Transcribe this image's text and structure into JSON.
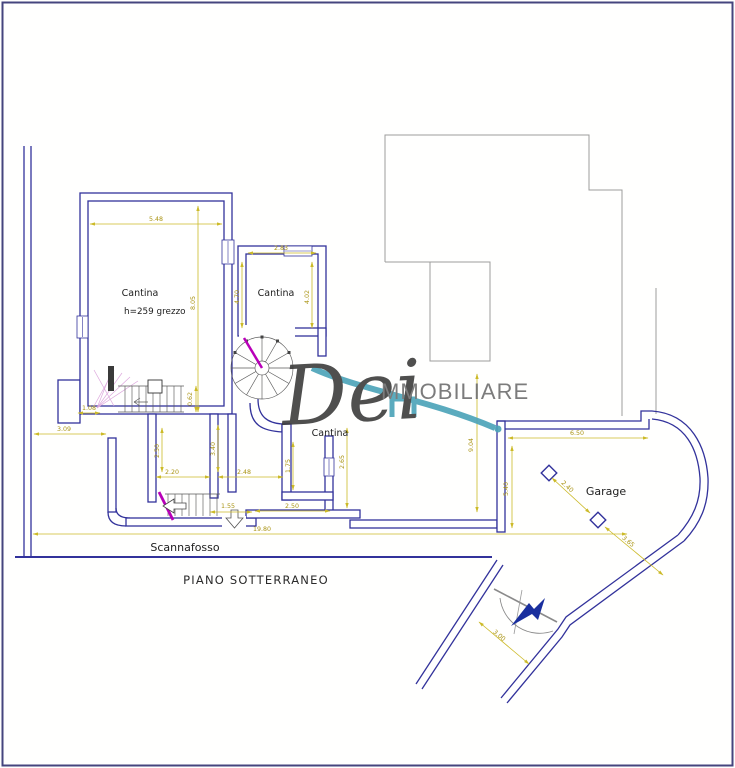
{
  "plan": {
    "title": "PIANO SOTTERRANEO",
    "rooms": {
      "cantina_nw": "Cantina",
      "cantina_nw_note": "h=259 grezzo",
      "cantina_mid": "Cantina",
      "cantina_south": "Cantina",
      "garage": "Garage",
      "scannafosso": "Scannafosso"
    },
    "dims": {
      "nw_width": "5.48",
      "nw_depth": "8.05",
      "mid_width": "2.83",
      "mid_left": "4.70",
      "mid_right": "4.02",
      "court_depth": "9.04",
      "garage_width": "6.50",
      "garage_depth": "5.40",
      "garage_diag_a": "2.40",
      "garage_diag_b": "3.65",
      "ramp_width": "3.00",
      "overall_width": "19.80",
      "west_gap": "3.09",
      "room_a_width": "2.20",
      "room_b_width": "2.48",
      "room_c_width": "2.50",
      "room_b_depth": "1.75",
      "room_c_depth": "2.65",
      "stair_room_depth": "2.50",
      "hall_depth": "3.40",
      "stair_width": "1.55",
      "stair_a": "1.08",
      "stair_b": "0.62"
    }
  },
  "watermark": {
    "script": "Dei",
    "caps": "MMOBILIARE"
  },
  "colors": {
    "wall": "#32329b",
    "dimension": "#b7a315",
    "accent_magenta": "#b800b8",
    "watermark_teal": "#4aa3b8",
    "arrow_blue": "#1a2f9e",
    "reference_gray": "#9c9c9c"
  }
}
